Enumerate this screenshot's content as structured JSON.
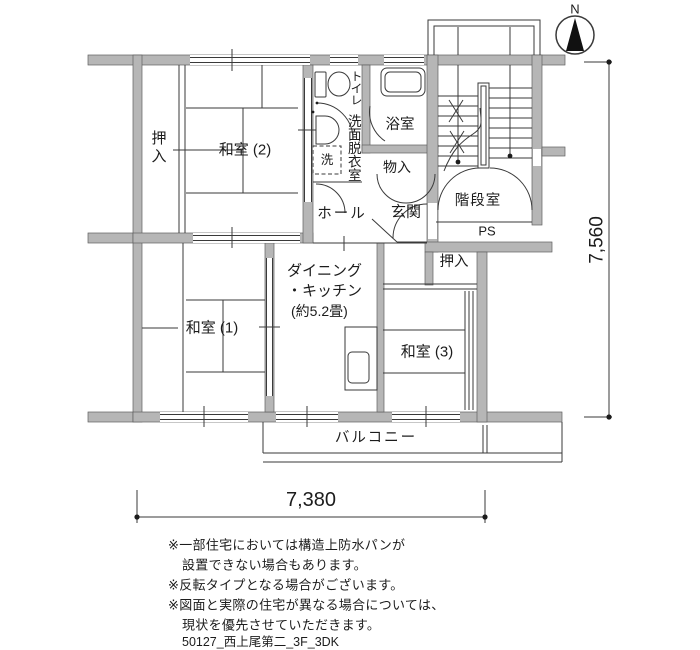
{
  "floor_plan": {
    "compass_label": "N",
    "rooms": {
      "oshiire_left": "押入",
      "washitsu_2": "和室 (2)",
      "toilet": "トイレ",
      "senmen_datsuishitsu": "洗面脱衣室",
      "washing_machine": "洗",
      "bathroom": "浴室",
      "monoire": "物入",
      "genkan": "玄関",
      "hall": "ホール",
      "stairwell": "階段室",
      "pipe_space": "PS",
      "oshiire_right": "押入",
      "dining_kitchen_line1": "ダイニング",
      "dining_kitchen_line2": "・キッチン",
      "dining_kitchen_line3": "(約5.2畳)",
      "washitsu_1": "和室 (1)",
      "washitsu_3": "和室 (3)",
      "balcony": "バルコニー"
    },
    "dimensions": {
      "width_mm": "7,380",
      "height_mm": "7,560"
    },
    "notes": [
      "※一部住宅においては構造上防水パンが",
      "設置できない場合もあります。",
      "※反転タイプとなる場合がございます。",
      "※図面と実際の住宅が異なる場合については、",
      "現状を優先させていただきます。"
    ],
    "plan_code": "50127_西上尾第二_3F_3DK",
    "colors": {
      "wall_fill": "#b6b6b6",
      "line": "#3a3a3a",
      "background": "#ffffff"
    }
  }
}
